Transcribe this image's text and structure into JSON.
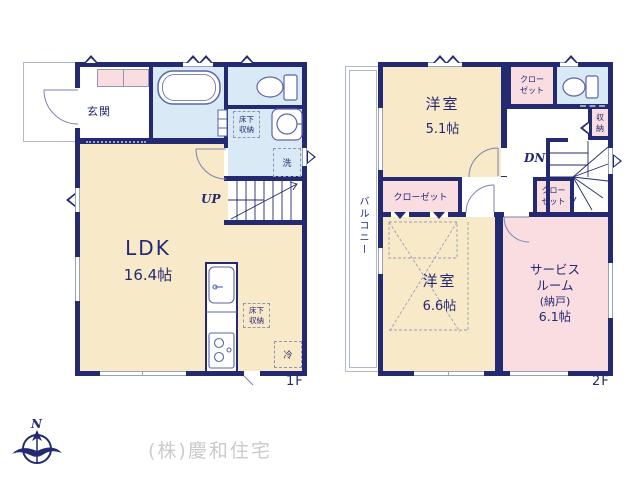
{
  "colors": {
    "wall": "#232a72",
    "room_cream": "#f8e9c8",
    "room_pink": "#f9dde1",
    "room_blue": "#d9e9f6",
    "fixture_line": "#5b66a8",
    "window_line": "#98a1c2",
    "text_navy": "#232a72",
    "company_gray": "#cbcbcb"
  },
  "floor1": {
    "floor_label": "1F",
    "entrance": "玄関",
    "ldk_name": "LDK",
    "ldk_size": "16.4帖",
    "stairs_up": "UP",
    "underfloor_storage_washroom_l1": "床下",
    "underfloor_storage_washroom_l2": "収納",
    "underfloor_storage_ldk_l1": "床下",
    "underfloor_storage_ldk_l2": "収納",
    "washer": "洗",
    "fridge": "冷"
  },
  "floor2": {
    "floor_label": "2F",
    "balcony": "バルコニー",
    "bedroom_small_name": "洋室",
    "bedroom_small_size": "5.1帖",
    "bedroom_large_name": "洋室",
    "bedroom_large_size": "6.6帖",
    "service_room_l1": "サービス",
    "service_room_l2": "ルーム",
    "service_room_l3": "(納戸)",
    "service_room_l4": "6.1帖",
    "closet_top_l1": "クロー",
    "closet_top_l2": "ゼット",
    "closet_mid_l1": "クロー",
    "closet_mid_l2": "ゼット",
    "closet_left": "クローゼット",
    "storage_l1": "収",
    "storage_l2": "納",
    "stairs_down": "DN"
  },
  "footer": {
    "compass_north": "N",
    "company": "(株)慶和住宅"
  }
}
